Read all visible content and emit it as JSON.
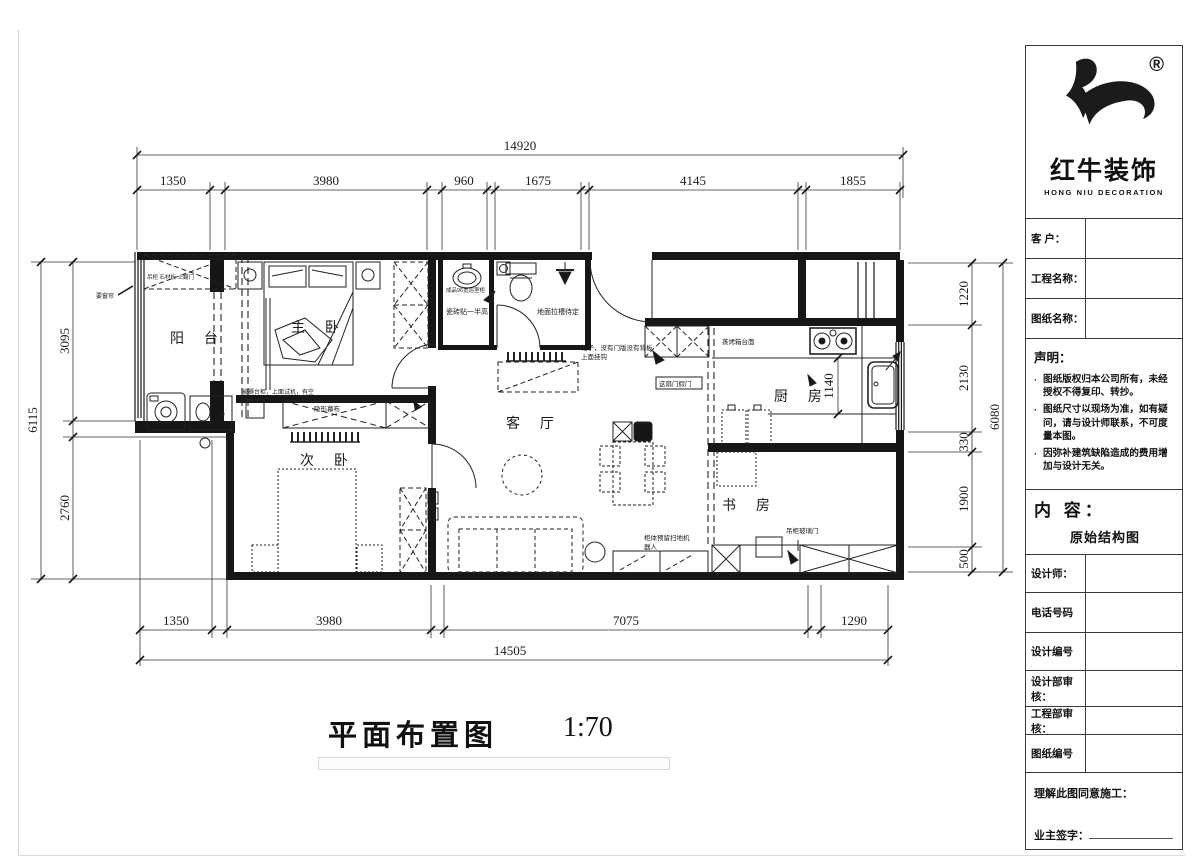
{
  "sheet": {
    "title": "平面布置图",
    "scale": "1:70"
  },
  "brand": {
    "name": "红牛装饰",
    "name_en": "HONG NIU DECORATION",
    "mark": "®"
  },
  "titleblock": {
    "customer_label": "客  户：",
    "project_label": "工程名称：",
    "sheet_name_label": "图纸名称：",
    "statement_title": "声明：",
    "statement_items": [
      "图纸版权归本公司所有，未经授权不得复印、转抄。",
      "图纸尺寸以现场为准，如有疑问，请与设计师联系，不可度量本图。",
      "因弥补建筑缺陷造成的费用增加与设计无关。"
    ],
    "content_label": "内 容：",
    "content_value": "原始结构图",
    "designer_label": "设计师：",
    "phone_label": "电话号码",
    "design_no_label": "设计编号",
    "design_review_label": "设计部审核：",
    "eng_review_label": "工程部审核：",
    "sheet_no_label": "图纸编号",
    "agree_label": "理解此图同意施工：",
    "owner_sign_label": "业主签字："
  },
  "rooms": {
    "balcony": "阳 台",
    "master": "主 卧",
    "secondary": "次 卧",
    "living": "客 厅",
    "kitchen": "厨 房",
    "study": "书 房"
  },
  "annotations": {
    "curtain": "要窗帘",
    "balcony_cabinet": "吊柜 石材板 上翻门",
    "master_quilt": "被褥台柜，上面试机，有空",
    "basin": "成品96宽浴室柜",
    "tile": "瓷砖贴一半高",
    "floor_groove": "地面拉槽待定",
    "hook_line1": "柜子，没有门版没有背板",
    "hook_line2": "上面挂钩",
    "fake_door": "这扇门假门",
    "oven": "蒸烤箱台面",
    "screen": "隐形幕布",
    "robot_line1": "柜体预留扫地机",
    "robot_line2": "器人",
    "glass_door": "吊柜玻璃门"
  },
  "dims": {
    "top_total": "14920",
    "top": [
      "1350",
      "3980",
      "960",
      "1675",
      "4145",
      "1855"
    ],
    "bottom": [
      "1350",
      "3980",
      "7075",
      "1290"
    ],
    "bottom_total": "14505",
    "left": [
      "3095",
      "2760"
    ],
    "left_total": "6115",
    "right": [
      "1220",
      "2130",
      "330",
      "1900",
      "500"
    ],
    "right_total": "6080",
    "kitchen_depth": "1140"
  }
}
